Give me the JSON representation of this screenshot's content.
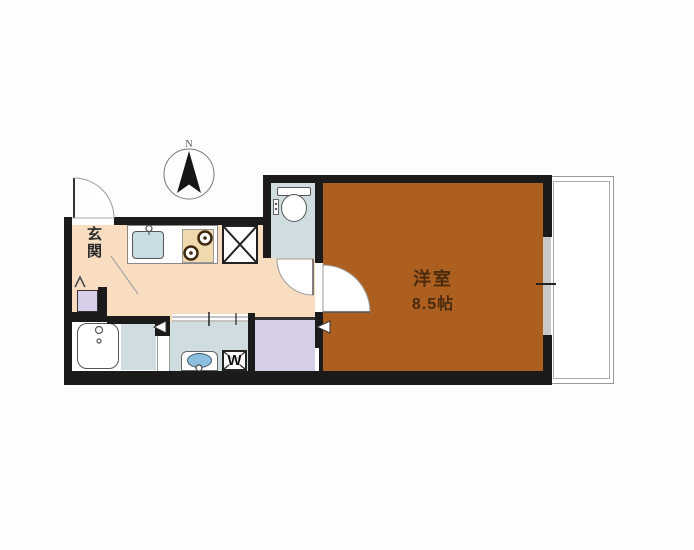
{
  "plan": {
    "type": "apartment-floor-plan",
    "compass": {
      "label": "N"
    },
    "rooms": {
      "genkan": {
        "label": "玄関"
      },
      "western_room": {
        "name": "洋室",
        "size": "8.5帖"
      },
      "toilet_room": {
        "fixture": "toilet"
      },
      "bathroom": {
        "fixture": "bathtub"
      },
      "washroom": {
        "fixtures": [
          "washbasin",
          "washing-machine-space"
        ]
      },
      "kitchen": {
        "fixtures": [
          "kitchen-sink",
          "gas-stove",
          "refrigerator-space"
        ]
      },
      "closet": {},
      "balcony": {}
    },
    "labels": {
      "washer": "W"
    },
    "colors": {
      "wall": "#1b1b1b",
      "western_room": "#ad5f1f",
      "kitchen_floor": "#f8ddc0",
      "wet_area_floor": "#cfdde1",
      "closet": "#d6cfe7",
      "sink": "#c8dce4",
      "basin": "#8cbfdf",
      "stove": "#f1d9ae",
      "room_text": "#4a2b0e"
    }
  }
}
